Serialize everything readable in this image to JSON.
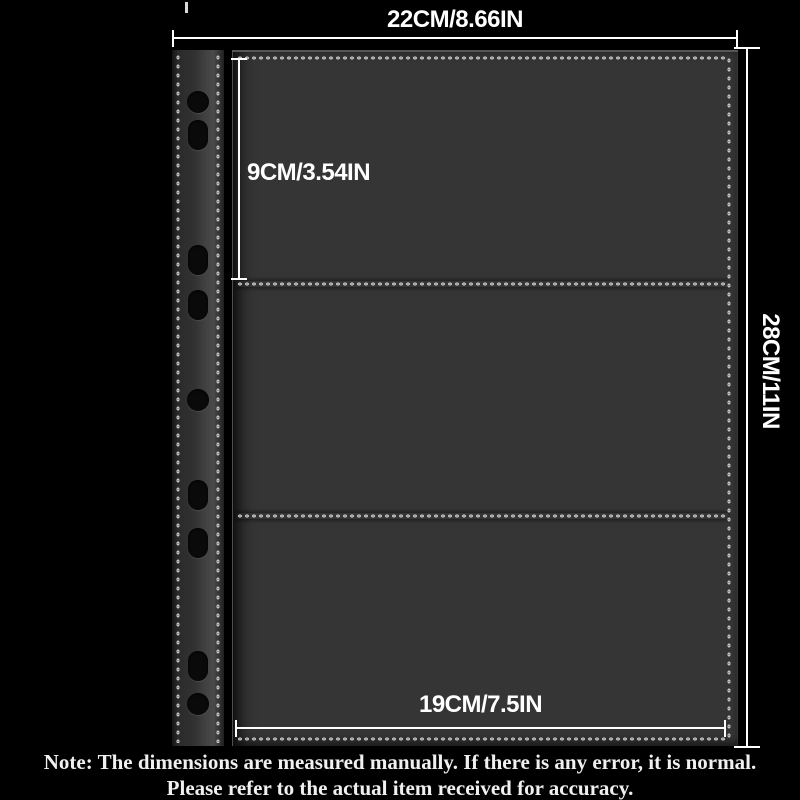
{
  "dimensions": {
    "width_label": "22CM/8.66IN",
    "pocket_height_label": "9CM/3.54IN",
    "page_height_label": "28CM/11IN",
    "pocket_width_label": "19CM/7.5IN"
  },
  "note": {
    "line1": "Note: The dimensions are measured manually. If there is any error, it is normal.",
    "line2": "Please refer to the actual item received for accuracy."
  },
  "product": {
    "description": "black 3-pocket binder sleeve page with stitched seams and punched spine holes",
    "pockets_count": 3,
    "binder_holes_count": 9
  },
  "colors": {
    "background": "#000000",
    "pocket_fill": "#353535",
    "stitch": "#cccccc",
    "dimension_lines": "#ffffff",
    "note_text": "#f0f0f0",
    "hole_fill": "#0a0a0a"
  }
}
